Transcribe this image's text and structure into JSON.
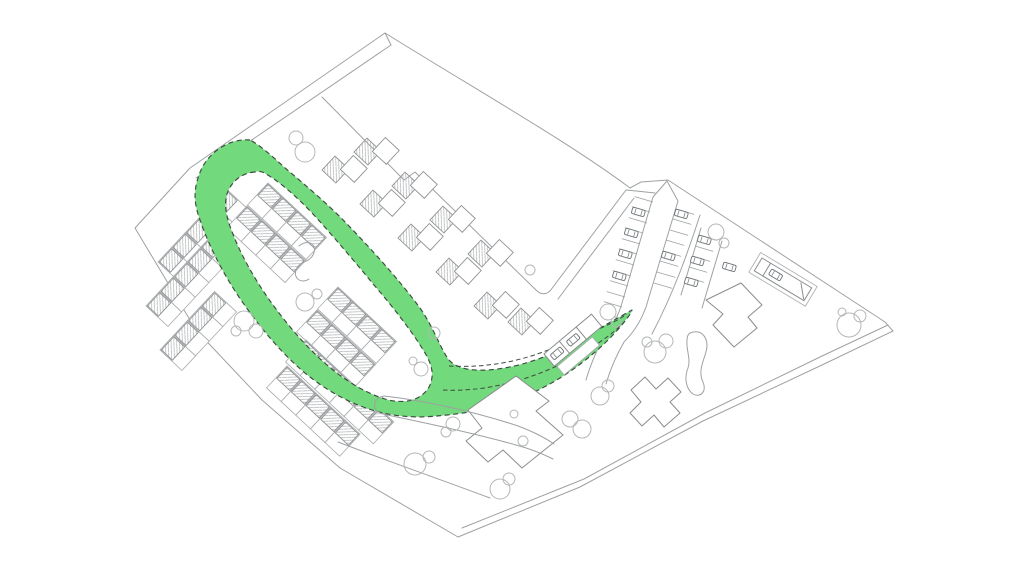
{
  "canvas": {
    "width": 1024,
    "height": 573,
    "background": "#ffffff"
  },
  "palette": {
    "highlight_green": "#72d97d",
    "dash_outline": "#3f4a41",
    "line_light": "#9ea1a3",
    "line_medium": "#8a8d90",
    "line_dark": "#6f7477",
    "tree_outline": "#b4b7b8",
    "hatch_line": "#abaeb0"
  },
  "plan": {
    "aria_label": "Masterplan site drawing with a looped green corridor highlighted over the street network"
  }
}
